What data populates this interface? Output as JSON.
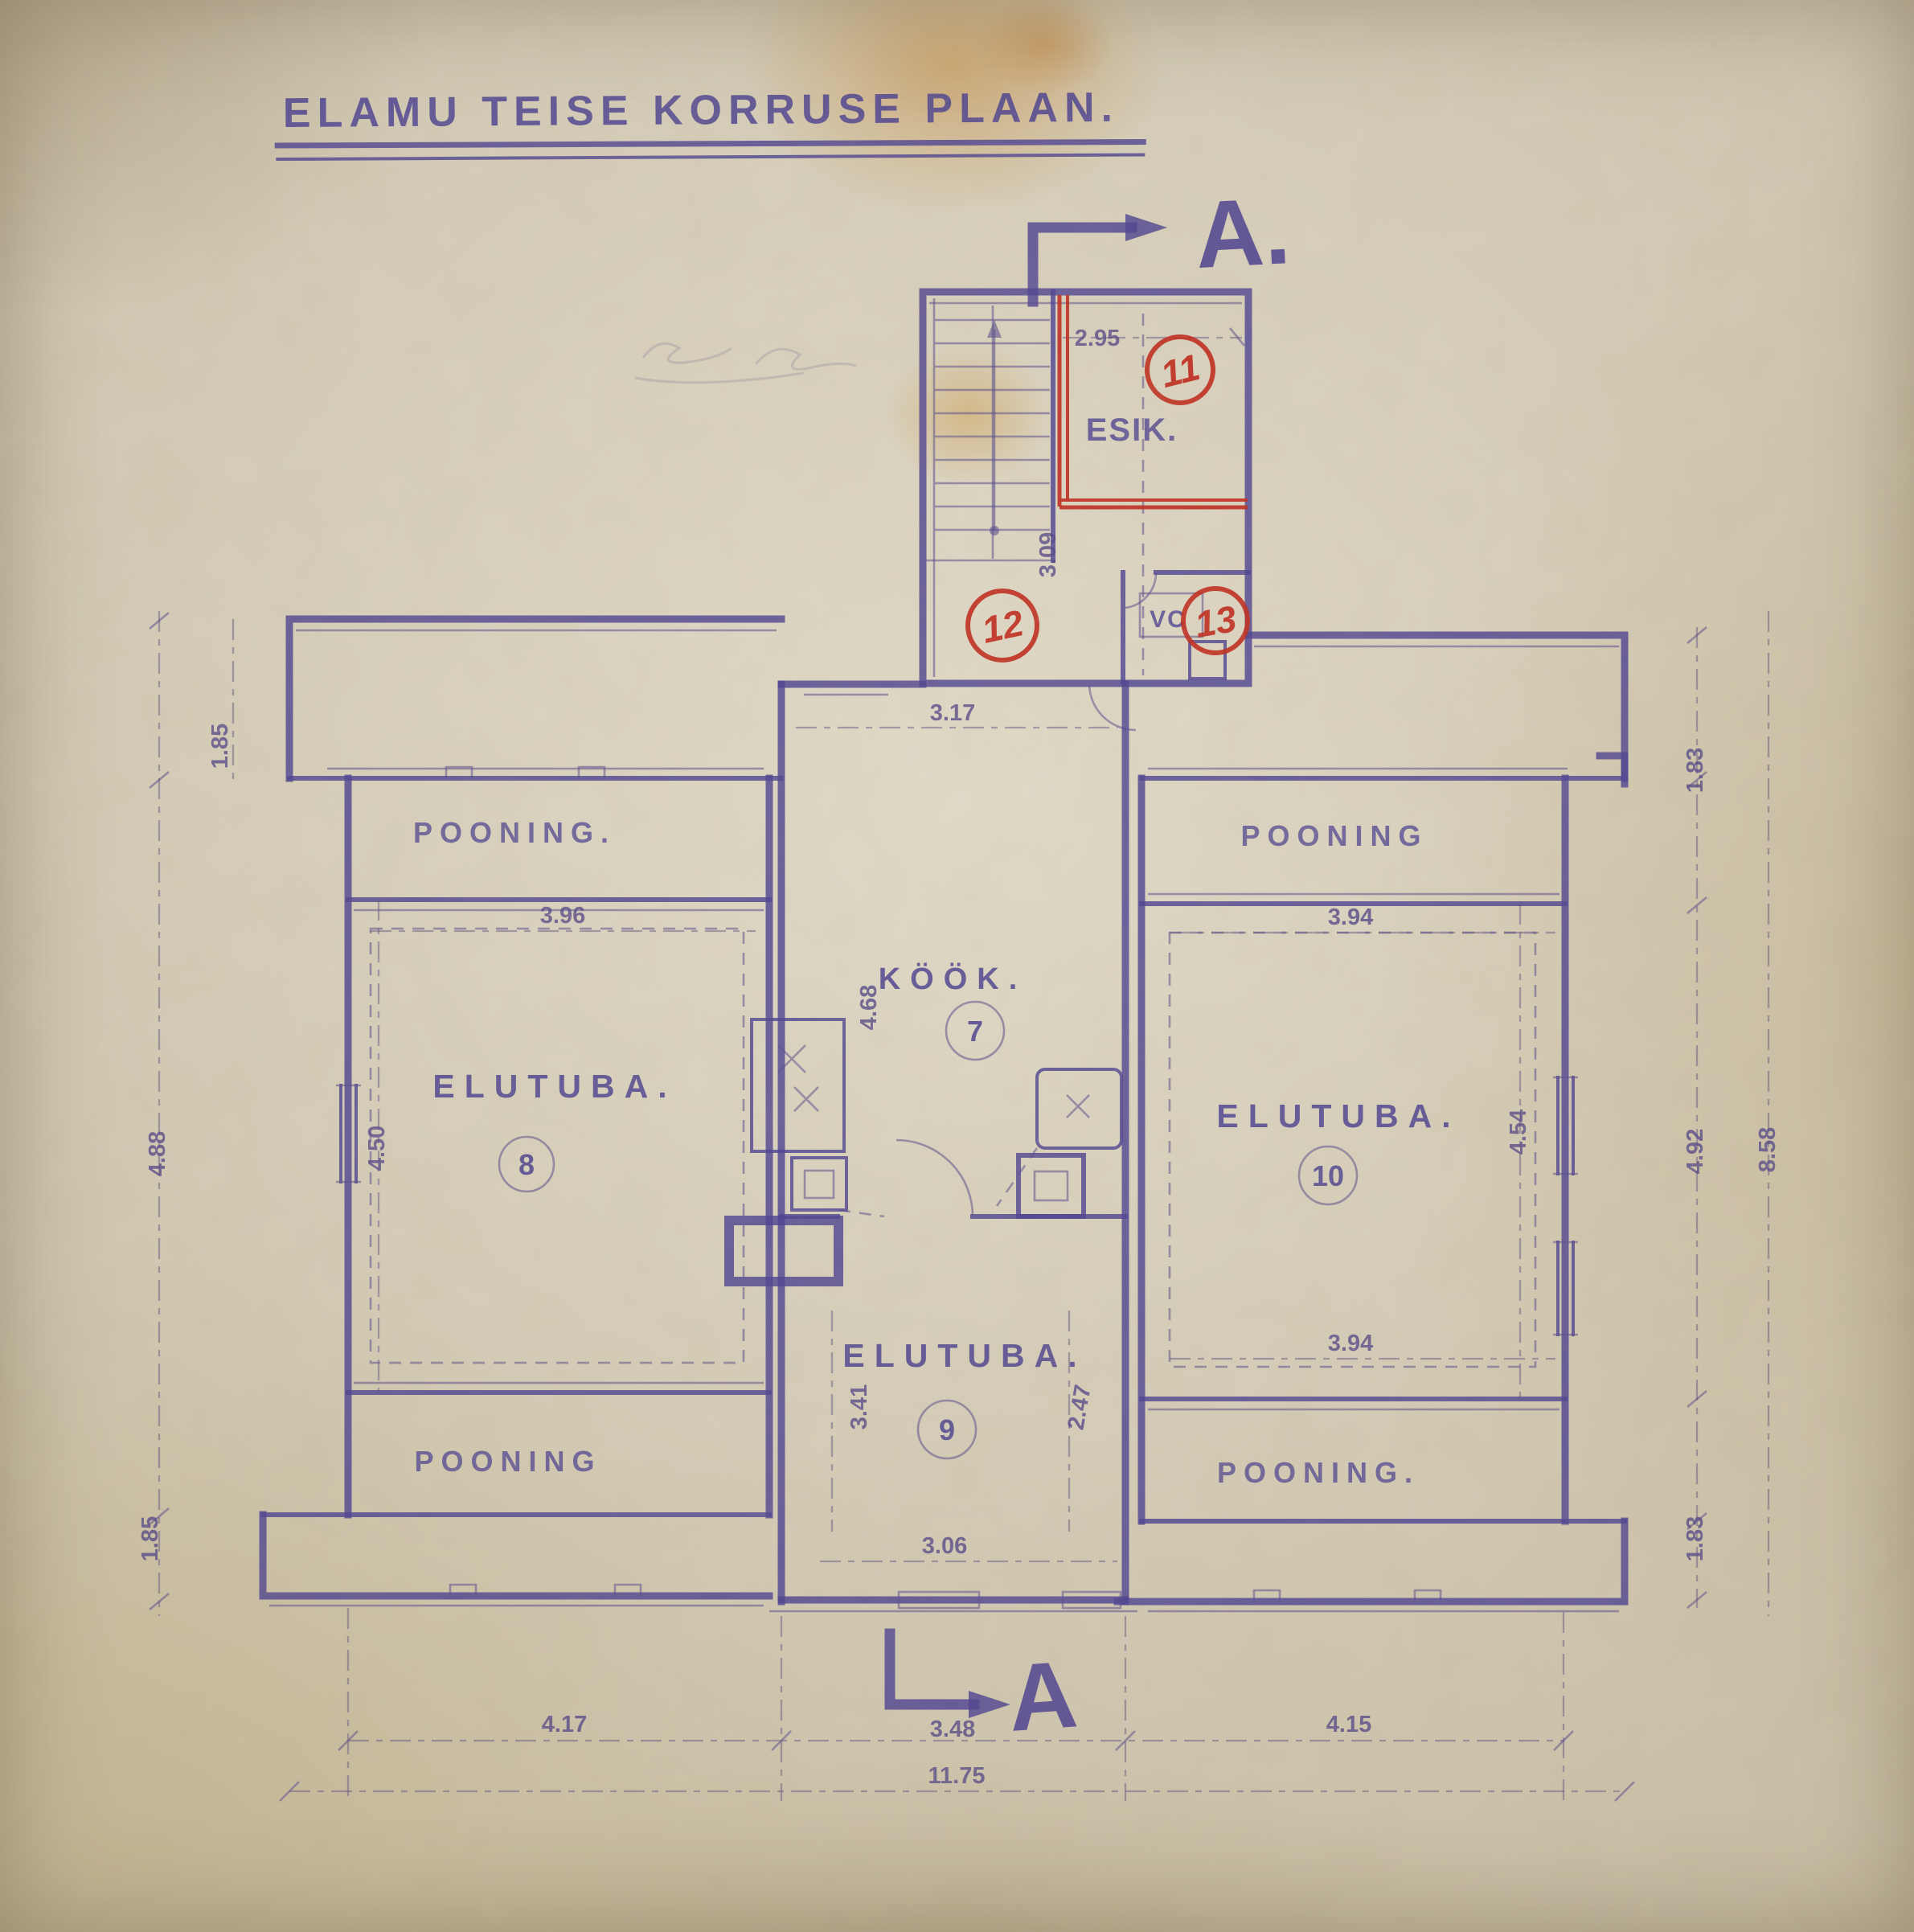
{
  "title": "ELAMU TEISE KORRUSE PLAAN.",
  "section_markers": {
    "top": "A.",
    "bottom": "A"
  },
  "colors": {
    "ink": "#4a3f92",
    "red_annotation": "#c1271b",
    "paper": "#d6cdb7"
  },
  "rooms": {
    "esik": {
      "label": "ESIK.",
      "number": "11"
    },
    "hall": {
      "number": "12"
    },
    "wc": {
      "label": "VC",
      "number": "13"
    },
    "kook": {
      "label": "KÖÖK.",
      "number": "7"
    },
    "elutuba8": {
      "label": "ELUTUBA.",
      "number": "8"
    },
    "elutuba9": {
      "label": "ELUTUBA.",
      "number": "9"
    },
    "elutuba10": {
      "label": "ELUTUBA.",
      "number": "10"
    },
    "pooning_tl": {
      "label": "POONING."
    },
    "pooning_tr": {
      "label": "POONING"
    },
    "pooning_bl": {
      "label": "POONING"
    },
    "pooning_br": {
      "label": "POONING."
    }
  },
  "dims": {
    "esik_width": "2.95",
    "stair_depth": "3.09",
    "hall_width": "3.17",
    "el8_width": "3.96",
    "el10_width_top": "3.94",
    "el10_width_bottom": "3.94",
    "left_outer": "4.88",
    "el8_height": "4.50",
    "left_band_top": "1.85",
    "left_band_bottom": "1.85",
    "right_band_top": "1.83",
    "right_band_bottom": "1.83",
    "el10_height": "4.54",
    "right_inner": "4.92",
    "right_outer": "8.58",
    "kook_height": "4.68",
    "el9_height": "3.41",
    "el9_right": "2.47",
    "el9_width": "3.06",
    "bottom_left": "4.17",
    "bottom_center": "3.48",
    "bottom_right": "4.15",
    "bottom_total": "11.75"
  }
}
